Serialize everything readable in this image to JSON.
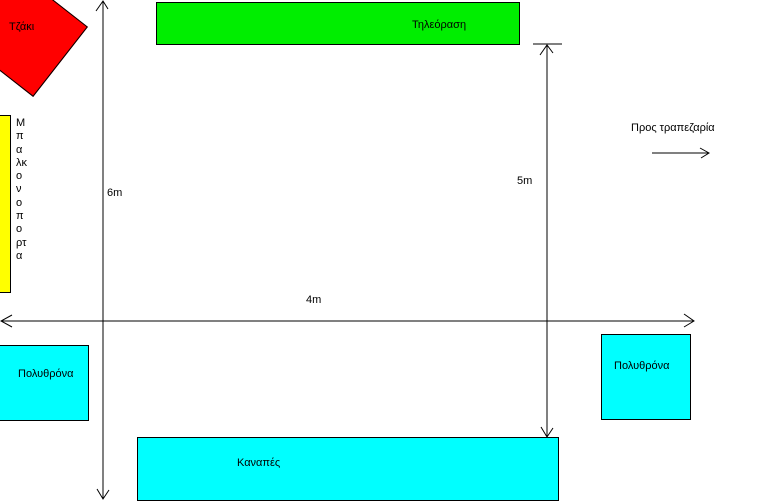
{
  "diagram": {
    "fireplace": {
      "label": "Τζάκι",
      "color": "#ff0000"
    },
    "tv": {
      "label": "Τηλεόραση",
      "color": "#00ee00"
    },
    "balcony_door": {
      "label": "Μπαλκονοπορτα",
      "color": "#ffff00"
    },
    "armchair_left": {
      "label": "Πολυθρόνα",
      "color": "#00ffff"
    },
    "armchair_right": {
      "label": "Πολυθρόνα",
      "color": "#00ffff"
    },
    "sofa": {
      "label": "Καναπές",
      "color": "#00ffff"
    },
    "dimensions": {
      "room_height": "6m",
      "inner_height": "5m",
      "room_width": "4m"
    },
    "annotations": {
      "to_dining": "Προς τραπεζαρία"
    },
    "line_color": "#000000"
  }
}
